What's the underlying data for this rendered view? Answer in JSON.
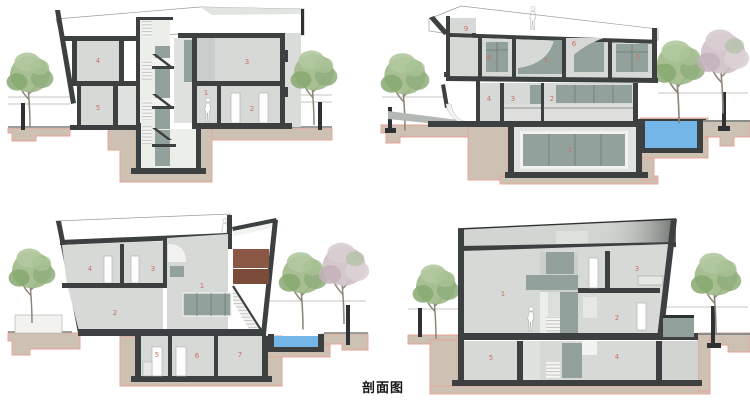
{
  "caption": "剖面图",
  "colors": {
    "wall": "#3d4040",
    "room_fill": "#d7d9d6",
    "panel_green": "#92a19b",
    "pool_blue": "#74b6e8",
    "foundation_tan": "#cdc1b3",
    "foundation_outline": "#e9a096",
    "label_red": "#cd6f63",
    "brown_upper": "#8a5744",
    "brown_lower": "#7c4c3b",
    "tree_green": "#9db886",
    "tree_pink": "#cfc0c7"
  },
  "sections": [
    {
      "name": "section-top-left",
      "rooms": [
        {
          "n": "4",
          "x": 98,
          "y": 63
        },
        {
          "n": "5",
          "x": 98,
          "y": 110
        },
        {
          "n": "3",
          "x": 247,
          "y": 64
        },
        {
          "n": "1",
          "x": 206,
          "y": 95
        },
        {
          "n": "2",
          "x": 252,
          "y": 111
        }
      ]
    },
    {
      "name": "section-top-right",
      "rooms": [
        {
          "n": "9",
          "x": 466,
          "y": 31
        },
        {
          "n": "8",
          "x": 489,
          "y": 60
        },
        {
          "n": "7",
          "x": 546,
          "y": 63
        },
        {
          "n": "6",
          "x": 574,
          "y": 46
        },
        {
          "n": "5",
          "x": 638,
          "y": 59
        },
        {
          "n": "4",
          "x": 489,
          "y": 101
        },
        {
          "n": "3",
          "x": 513,
          "y": 101
        },
        {
          "n": "2",
          "x": 552,
          "y": 101
        },
        {
          "n": "1",
          "x": 570,
          "y": 152
        }
      ]
    },
    {
      "name": "section-bottom-left",
      "rooms": [
        {
          "n": "4",
          "x": 90,
          "y": 271
        },
        {
          "n": "3",
          "x": 153,
          "y": 271
        },
        {
          "n": "1",
          "x": 202,
          "y": 288
        },
        {
          "n": "2",
          "x": 115,
          "y": 315
        },
        {
          "n": "5",
          "x": 157,
          "y": 357
        },
        {
          "n": "6",
          "x": 197,
          "y": 358
        },
        {
          "n": "7",
          "x": 240,
          "y": 357
        }
      ]
    },
    {
      "name": "section-bottom-right",
      "rooms": [
        {
          "n": "1",
          "x": 503,
          "y": 296
        },
        {
          "n": "3",
          "x": 637,
          "y": 271
        },
        {
          "n": "2",
          "x": 617,
          "y": 320
        },
        {
          "n": "5",
          "x": 491,
          "y": 360
        },
        {
          "n": "4",
          "x": 617,
          "y": 359
        }
      ]
    }
  ]
}
